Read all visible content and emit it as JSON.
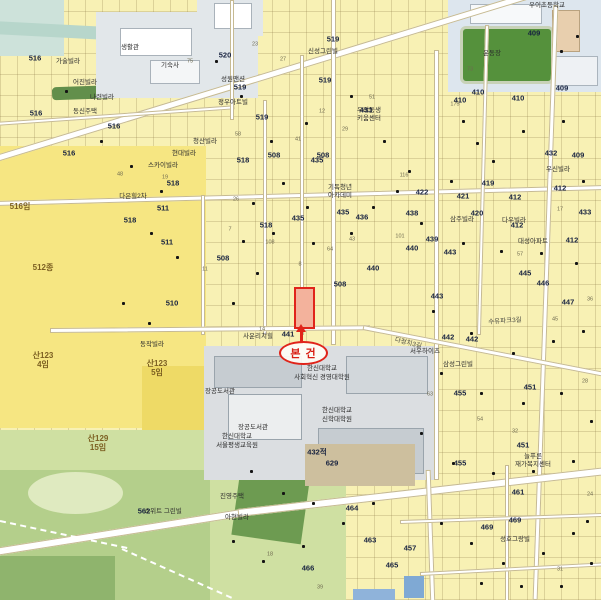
{
  "annotation": {
    "label": "본 건"
  },
  "colors": {
    "annotation_red": "#e0241a",
    "parcel_yellow": "#f8f1b4",
    "open_land_yellow": "#f6e682",
    "park_green": "#cfe0a2",
    "campus_gray": "#dbdee1",
    "school_gray_blue": "#dde6ee",
    "field_green": "#55913c",
    "water_teal": "#b7d6cb",
    "road_white": "#ffffff"
  },
  "map": {
    "parcel_numbers": [
      {
        "t": "520",
        "x": 225,
        "y": 55
      },
      {
        "t": "516",
        "x": 35,
        "y": 58
      },
      {
        "t": "516",
        "x": 36,
        "y": 113
      },
      {
        "t": "516",
        "x": 114,
        "y": 126
      },
      {
        "t": "516",
        "x": 69,
        "y": 153
      },
      {
        "t": "519",
        "x": 333,
        "y": 39
      },
      {
        "t": "519",
        "x": 240,
        "y": 87
      },
      {
        "t": "519",
        "x": 262,
        "y": 117
      },
      {
        "t": "519",
        "x": 325,
        "y": 80
      },
      {
        "t": "518",
        "x": 173,
        "y": 183
      },
      {
        "t": "518",
        "x": 130,
        "y": 220
      },
      {
        "t": "518",
        "x": 243,
        "y": 160
      },
      {
        "t": "518",
        "x": 266,
        "y": 225
      },
      {
        "t": "508",
        "x": 274,
        "y": 155
      },
      {
        "t": "508",
        "x": 323,
        "y": 155
      },
      {
        "t": "508",
        "x": 223,
        "y": 258
      },
      {
        "t": "508",
        "x": 340,
        "y": 284
      },
      {
        "t": "441",
        "x": 288,
        "y": 334
      },
      {
        "t": "435",
        "x": 317,
        "y": 160
      },
      {
        "t": "435",
        "x": 298,
        "y": 218
      },
      {
        "t": "435",
        "x": 343,
        "y": 212
      },
      {
        "t": "436",
        "x": 362,
        "y": 217
      },
      {
        "t": "440",
        "x": 373,
        "y": 268
      },
      {
        "t": "440",
        "x": 412,
        "y": 248
      },
      {
        "t": "412",
        "x": 515,
        "y": 197
      },
      {
        "t": "412",
        "x": 560,
        "y": 188
      },
      {
        "t": "412",
        "x": 517,
        "y": 225
      },
      {
        "t": "412",
        "x": 572,
        "y": 240
      },
      {
        "t": "409",
        "x": 534,
        "y": 33
      },
      {
        "t": "409",
        "x": 562,
        "y": 88
      },
      {
        "t": "409",
        "x": 578,
        "y": 155
      },
      {
        "t": "410",
        "x": 460,
        "y": 100
      },
      {
        "t": "410",
        "x": 478,
        "y": 92
      },
      {
        "t": "410",
        "x": 518,
        "y": 98
      },
      {
        "t": "419",
        "x": 488,
        "y": 183
      },
      {
        "t": "420",
        "x": 477,
        "y": 213
      },
      {
        "t": "421",
        "x": 463,
        "y": 196
      },
      {
        "t": "422",
        "x": 422,
        "y": 192
      },
      {
        "t": "433",
        "x": 585,
        "y": 212
      },
      {
        "t": "433",
        "x": 366,
        "y": 110
      },
      {
        "t": "438",
        "x": 412,
        "y": 213
      },
      {
        "t": "439",
        "x": 432,
        "y": 239
      },
      {
        "t": "443",
        "x": 450,
        "y": 252
      },
      {
        "t": "443",
        "x": 437,
        "y": 296
      },
      {
        "t": "445",
        "x": 525,
        "y": 273
      },
      {
        "t": "446",
        "x": 543,
        "y": 283
      },
      {
        "t": "447",
        "x": 568,
        "y": 302
      },
      {
        "t": "442",
        "x": 448,
        "y": 337
      },
      {
        "t": "442",
        "x": 472,
        "y": 339
      },
      {
        "t": "451",
        "x": 530,
        "y": 387
      },
      {
        "t": "451",
        "x": 523,
        "y": 445
      },
      {
        "t": "455",
        "x": 460,
        "y": 393
      },
      {
        "t": "455",
        "x": 460,
        "y": 463
      },
      {
        "t": "457",
        "x": 410,
        "y": 548
      },
      {
        "t": "461",
        "x": 518,
        "y": 492
      },
      {
        "t": "463",
        "x": 370,
        "y": 540
      },
      {
        "t": "464",
        "x": 352,
        "y": 508
      },
      {
        "t": "465",
        "x": 392,
        "y": 565
      },
      {
        "t": "466",
        "x": 308,
        "y": 568
      },
      {
        "t": "469",
        "x": 487,
        "y": 527
      },
      {
        "t": "469",
        "x": 515,
        "y": 520
      },
      {
        "t": "510",
        "x": 172,
        "y": 303
      },
      {
        "t": "511",
        "x": 163,
        "y": 208
      },
      {
        "t": "511",
        "x": 167,
        "y": 242
      },
      {
        "t": "562",
        "x": 144,
        "y": 511
      },
      {
        "t": "629",
        "x": 332,
        "y": 463
      },
      {
        "t": "432",
        "x": 551,
        "y": 153
      },
      {
        "t": "432적",
        "x": 317,
        "y": 452
      }
    ],
    "place_names": [
      {
        "t": "우이초등학교",
        "x": 547,
        "y": 6
      },
      {
        "t": "생활관",
        "x": 130,
        "y": 48
      },
      {
        "t": "기숙사",
        "x": 170,
        "y": 66
      },
      {
        "t": "운동장",
        "x": 492,
        "y": 54
      },
      {
        "t": "한신대학교",
        "x": 322,
        "y": 369
      },
      {
        "t": "사회혁신 경영대학원",
        "x": 322,
        "y": 378
      },
      {
        "t": "한신대학교",
        "x": 337,
        "y": 411
      },
      {
        "t": "신학대학원",
        "x": 337,
        "y": 420
      },
      {
        "t": "장공도서관",
        "x": 220,
        "y": 392
      },
      {
        "t": "장공도서관",
        "x": 253,
        "y": 428
      },
      {
        "t": "한신대학교",
        "x": 237,
        "y": 437
      },
      {
        "t": "서울평생교육원",
        "x": 237,
        "y": 446
      },
      {
        "t": "청산빌라",
        "x": 205,
        "y": 142
      },
      {
        "t": "현대빌라",
        "x": 184,
        "y": 154
      },
      {
        "t": "스카이빌라",
        "x": 163,
        "y": 166
      },
      {
        "t": "성원맨션",
        "x": 233,
        "y": 80
      },
      {
        "t": "정우아트빌",
        "x": 233,
        "y": 103
      },
      {
        "t": "신성그린빌",
        "x": 323,
        "y": 52
      },
      {
        "t": "우리동생",
        "x": 369,
        "y": 111
      },
      {
        "t": "키움센터",
        "x": 369,
        "y": 119
      },
      {
        "t": "동신주택",
        "x": 85,
        "y": 112
      },
      {
        "t": "어진빌라",
        "x": 85,
        "y": 83
      },
      {
        "t": "나련빌라",
        "x": 102,
        "y": 98
      },
      {
        "t": "가술빌라",
        "x": 68,
        "y": 62
      },
      {
        "t": "삼성그린빌",
        "x": 458,
        "y": 365
      },
      {
        "t": "서우하이츠",
        "x": 425,
        "y": 352
      },
      {
        "t": "성호그랑빌",
        "x": 515,
        "y": 540
      },
      {
        "t": "대성아파트",
        "x": 533,
        "y": 242
      },
      {
        "t": "삼주빌라",
        "x": 462,
        "y": 220
      },
      {
        "t": "다우빌라",
        "x": 514,
        "y": 221
      },
      {
        "t": "동작빌라",
        "x": 152,
        "y": 345
      },
      {
        "t": "스위트 그린빌",
        "x": 163,
        "y": 512
      },
      {
        "t": "사운리치힐",
        "x": 258,
        "y": 337
      },
      {
        "t": "우신빌라",
        "x": 558,
        "y": 170
      },
      {
        "t": "다은힐2차",
        "x": 133,
        "y": 197
      },
      {
        "t": "진영주택",
        "x": 232,
        "y": 497
      },
      {
        "t": "아현빌라",
        "x": 237,
        "y": 518
      },
      {
        "t": "늘푸른",
        "x": 533,
        "y": 457
      },
      {
        "t": "재가복지센터",
        "x": 533,
        "y": 465
      },
      {
        "t": "기독청년",
        "x": 340,
        "y": 188
      },
      {
        "t": "아카데미",
        "x": 340,
        "y": 196
      }
    ],
    "road_names": [
      {
        "t": "다정치3길",
        "x": 408,
        "y": 344,
        "r": 14
      },
      {
        "t": "수유파크3길",
        "x": 505,
        "y": 322,
        "r": -4
      }
    ],
    "area_labels": [
      {
        "t": "산123",
        "x": 43,
        "y": 356
      },
      {
        "t": "4임",
        "x": 43,
        "y": 365
      },
      {
        "t": "산123",
        "x": 157,
        "y": 364
      },
      {
        "t": "5임",
        "x": 157,
        "y": 373
      },
      {
        "t": "산129",
        "x": 98,
        "y": 439
      },
      {
        "t": "15임",
        "x": 98,
        "y": 448
      },
      {
        "t": "516임",
        "x": 20,
        "y": 207
      },
      {
        "t": "512종",
        "x": 43,
        "y": 268
      }
    ],
    "lot_numbers": [
      {
        "t": "23",
        "x": 255,
        "y": 45
      },
      {
        "t": "27",
        "x": 283,
        "y": 60
      },
      {
        "t": "14",
        "x": 262,
        "y": 330
      },
      {
        "t": "58",
        "x": 238,
        "y": 135
      },
      {
        "t": "75",
        "x": 190,
        "y": 62
      },
      {
        "t": "41",
        "x": 298,
        "y": 140
      },
      {
        "t": "12",
        "x": 322,
        "y": 112
      },
      {
        "t": "29",
        "x": 345,
        "y": 130
      },
      {
        "t": "51",
        "x": 372,
        "y": 98
      },
      {
        "t": "8",
        "x": 300,
        "y": 265
      },
      {
        "t": "64",
        "x": 330,
        "y": 250
      },
      {
        "t": "43",
        "x": 352,
        "y": 240
      },
      {
        "t": "108",
        "x": 270,
        "y": 243
      },
      {
        "t": "175",
        "x": 455,
        "y": 105
      },
      {
        "t": "116",
        "x": 404,
        "y": 176
      },
      {
        "t": "101",
        "x": 400,
        "y": 237
      },
      {
        "t": "57",
        "x": 520,
        "y": 255
      },
      {
        "t": "73",
        "x": 470,
        "y": 70
      },
      {
        "t": "21",
        "x": 300,
        "y": 305
      },
      {
        "t": "26",
        "x": 236,
        "y": 200
      },
      {
        "t": "17",
        "x": 560,
        "y": 210
      },
      {
        "t": "36",
        "x": 590,
        "y": 300
      },
      {
        "t": "45",
        "x": 555,
        "y": 320
      },
      {
        "t": "63",
        "x": 430,
        "y": 395
      },
      {
        "t": "54",
        "x": 480,
        "y": 420
      },
      {
        "t": "32",
        "x": 515,
        "y": 432
      },
      {
        "t": "28",
        "x": 585,
        "y": 382
      },
      {
        "t": "19",
        "x": 165,
        "y": 178
      },
      {
        "t": "48",
        "x": 120,
        "y": 175
      },
      {
        "t": "7",
        "x": 230,
        "y": 230
      },
      {
        "t": "24",
        "x": 590,
        "y": 495
      },
      {
        "t": "31",
        "x": 560,
        "y": 570
      },
      {
        "t": "18",
        "x": 270,
        "y": 555
      },
      {
        "t": "39",
        "x": 320,
        "y": 588
      },
      {
        "t": "11",
        "x": 205,
        "y": 270
      }
    ],
    "building_markers": [
      [
        215,
        60
      ],
      [
        240,
        95
      ],
      [
        270,
        140
      ],
      [
        305,
        122
      ],
      [
        350,
        95
      ],
      [
        383,
        140
      ],
      [
        408,
        170
      ],
      [
        450,
        180
      ],
      [
        492,
        160
      ],
      [
        522,
        130
      ],
      [
        562,
        120
      ],
      [
        582,
        180
      ],
      [
        420,
        222
      ],
      [
        462,
        242
      ],
      [
        500,
        250
      ],
      [
        540,
        252
      ],
      [
        575,
        262
      ],
      [
        350,
        232
      ],
      [
        312,
        242
      ],
      [
        272,
        232
      ],
      [
        242,
        240
      ],
      [
        130,
        165
      ],
      [
        160,
        190
      ],
      [
        100,
        140
      ],
      [
        65,
        90
      ],
      [
        432,
        310
      ],
      [
        470,
        332
      ],
      [
        512,
        352
      ],
      [
        552,
        340
      ],
      [
        582,
        330
      ],
      [
        440,
        372
      ],
      [
        480,
        392
      ],
      [
        522,
        402
      ],
      [
        560,
        392
      ],
      [
        590,
        420
      ],
      [
        420,
        432
      ],
      [
        452,
        462
      ],
      [
        492,
        472
      ],
      [
        532,
        470
      ],
      [
        572,
        460
      ],
      [
        250,
        470
      ],
      [
        282,
        492
      ],
      [
        312,
        502
      ],
      [
        342,
        522
      ],
      [
        372,
        502
      ],
      [
        232,
        540
      ],
      [
        262,
        560
      ],
      [
        302,
        545
      ],
      [
        440,
        522
      ],
      [
        470,
        542
      ],
      [
        502,
        562
      ],
      [
        542,
        552
      ],
      [
        572,
        532
      ],
      [
        590,
        562
      ],
      [
        150,
        232
      ],
      [
        176,
        256
      ],
      [
        122,
        302
      ],
      [
        148,
        322
      ],
      [
        252,
        202
      ],
      [
        282,
        182
      ],
      [
        232,
        302
      ],
      [
        256,
        272
      ],
      [
        306,
        206
      ],
      [
        372,
        206
      ],
      [
        396,
        190
      ],
      [
        576,
        35
      ],
      [
        560,
        50
      ],
      [
        462,
        120
      ],
      [
        476,
        142
      ],
      [
        586,
        520
      ],
      [
        560,
        585
      ],
      [
        520,
        585
      ],
      [
        480,
        582
      ]
    ]
  }
}
